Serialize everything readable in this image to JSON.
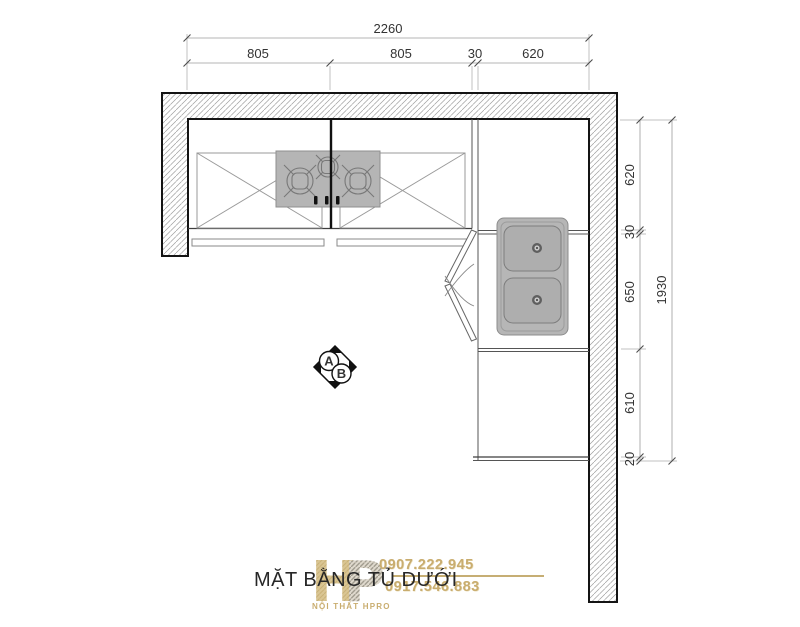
{
  "title": "MẶT BẰNG TỦ DƯỚI",
  "dimensions": {
    "top": {
      "overall": "2260",
      "segments": [
        "805",
        "805",
        "30",
        "620"
      ]
    },
    "right": {
      "overall": "1930",
      "segments": [
        "620",
        "30",
        "650",
        "610",
        "20"
      ]
    }
  },
  "section_marker": {
    "label_a": "A",
    "label_b": "B"
  },
  "watermark": {
    "logo_h": "H",
    "logo_p": "P",
    "company": "NỘI THẤT HPRO",
    "phone_1": "0907.222.945",
    "phone_2": "0917.546.883"
  },
  "colors": {
    "appliance_gray": "#b5b5b5",
    "wall_outline": "#141414",
    "dim_text": "#333333",
    "watermark_tan": "#c9ad6f"
  }
}
